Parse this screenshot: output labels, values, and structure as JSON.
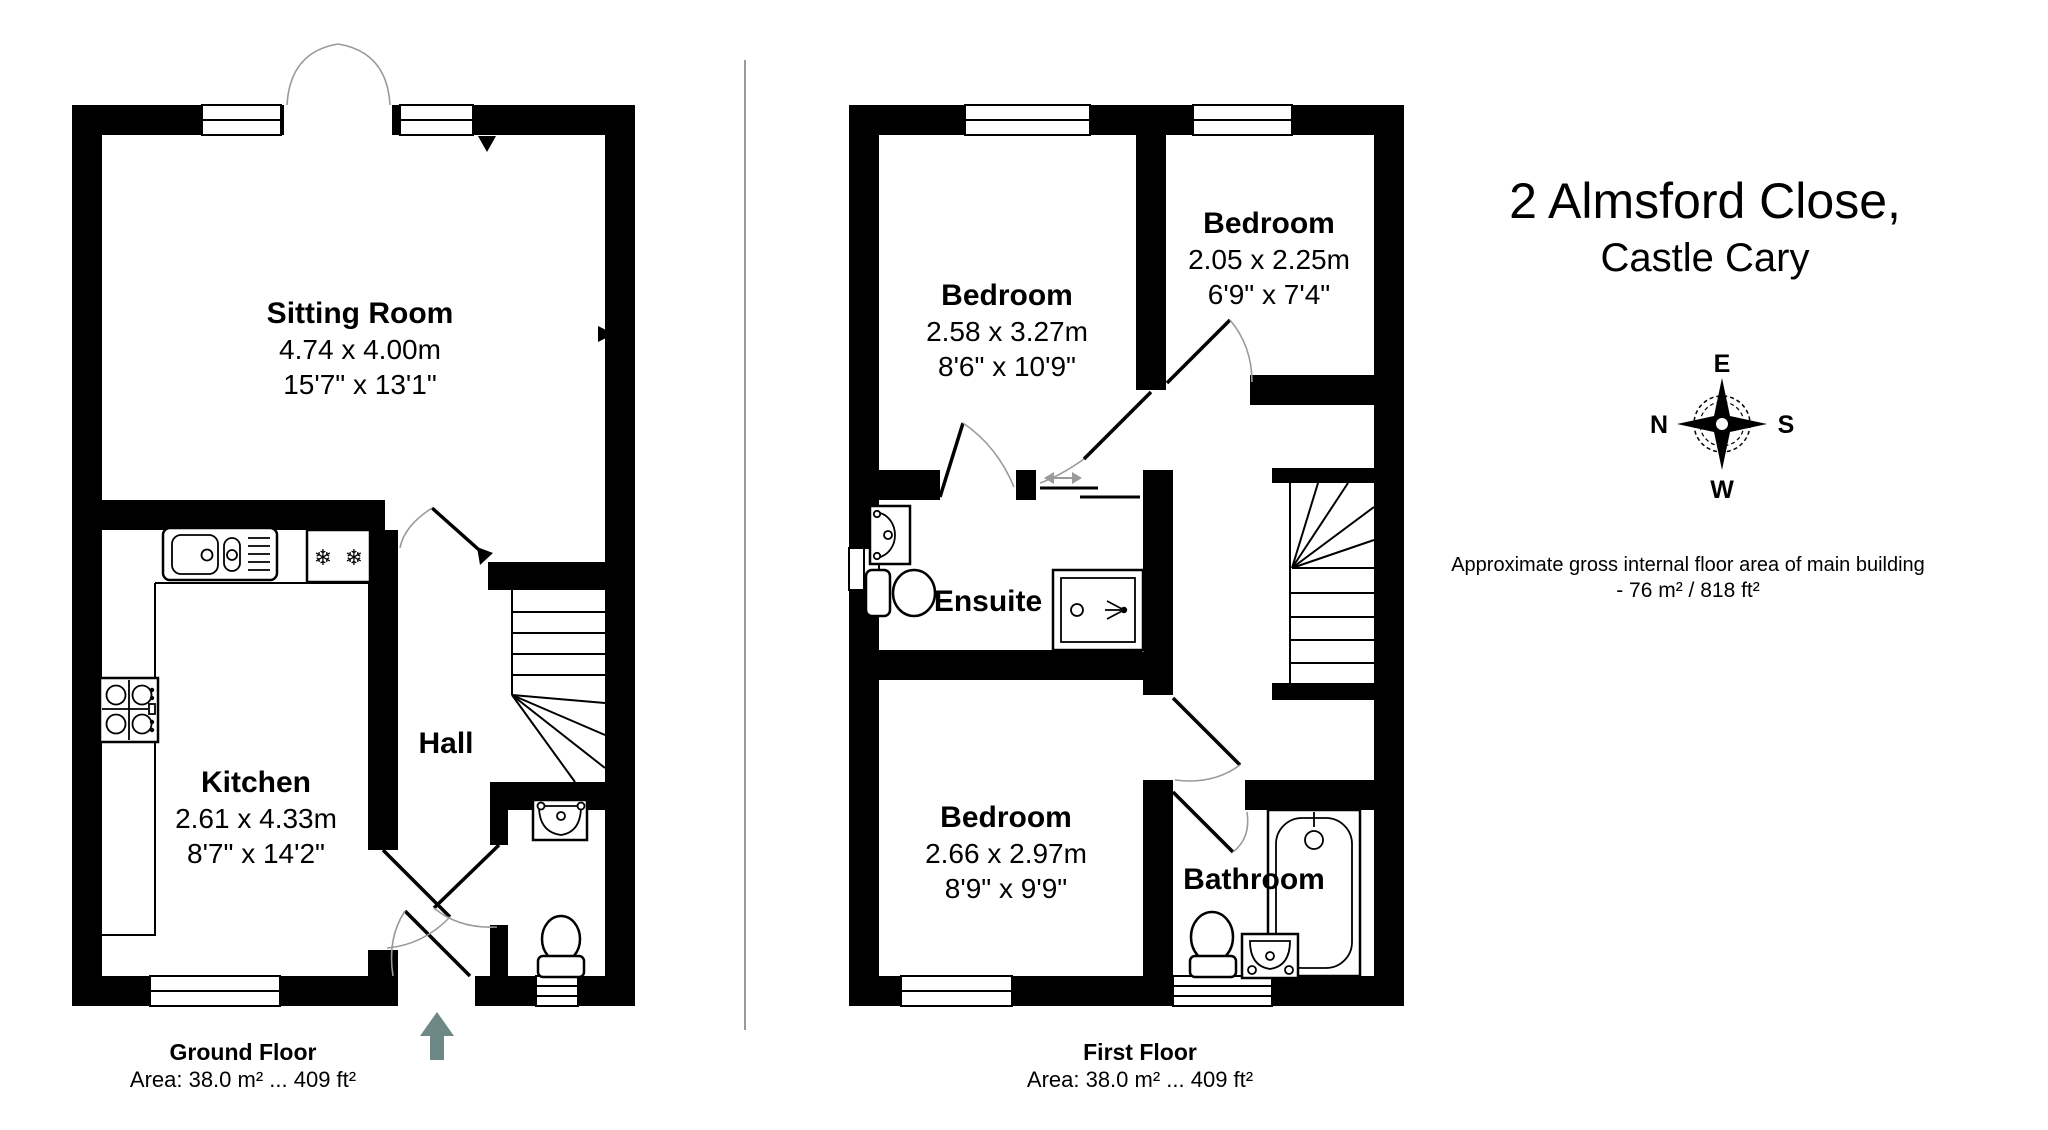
{
  "title": {
    "line1": "2 Almsford Close,",
    "line2": "Castle Cary"
  },
  "area_note": {
    "line1": "Approximate gross internal floor area of main building",
    "line2": "-  76 m²  /  818 ft²"
  },
  "compass": {
    "top": "E",
    "left": "N",
    "right": "S",
    "bottom": "W"
  },
  "icons": {
    "snowflake": "❄"
  },
  "ground_floor": {
    "footer_title": "Ground Floor",
    "footer_area": "Area: 38.0 m² ... 409 ft²",
    "rooms": {
      "sitting_room": {
        "name": "Sitting Room",
        "dim_m": "4.74 x 4.00m",
        "dim_ft": "15'7\" x 13'1\""
      },
      "kitchen": {
        "name": "Kitchen",
        "dim_m": "2.61 x 4.33m",
        "dim_ft": "8'7\" x 14'2\""
      },
      "hall": {
        "name": "Hall"
      }
    }
  },
  "first_floor": {
    "footer_title": "First Floor",
    "footer_area": "Area: 38.0 m² ... 409 ft²",
    "rooms": {
      "bedroom_1": {
        "name": "Bedroom",
        "dim_m": "2.58 x 3.27m",
        "dim_ft": "8'6\" x 10'9\""
      },
      "bedroom_2": {
        "name": "Bedroom",
        "dim_m": "2.05 x 2.25m",
        "dim_ft": "6'9\" x 7'4\""
      },
      "ensuite": {
        "name": "Ensuite"
      },
      "bedroom_3": {
        "name": "Bedroom",
        "dim_m": "2.66 x 2.97m",
        "dim_ft": "8'9\" x 9'9\""
      },
      "bathroom": {
        "name": "Bathroom"
      }
    }
  }
}
